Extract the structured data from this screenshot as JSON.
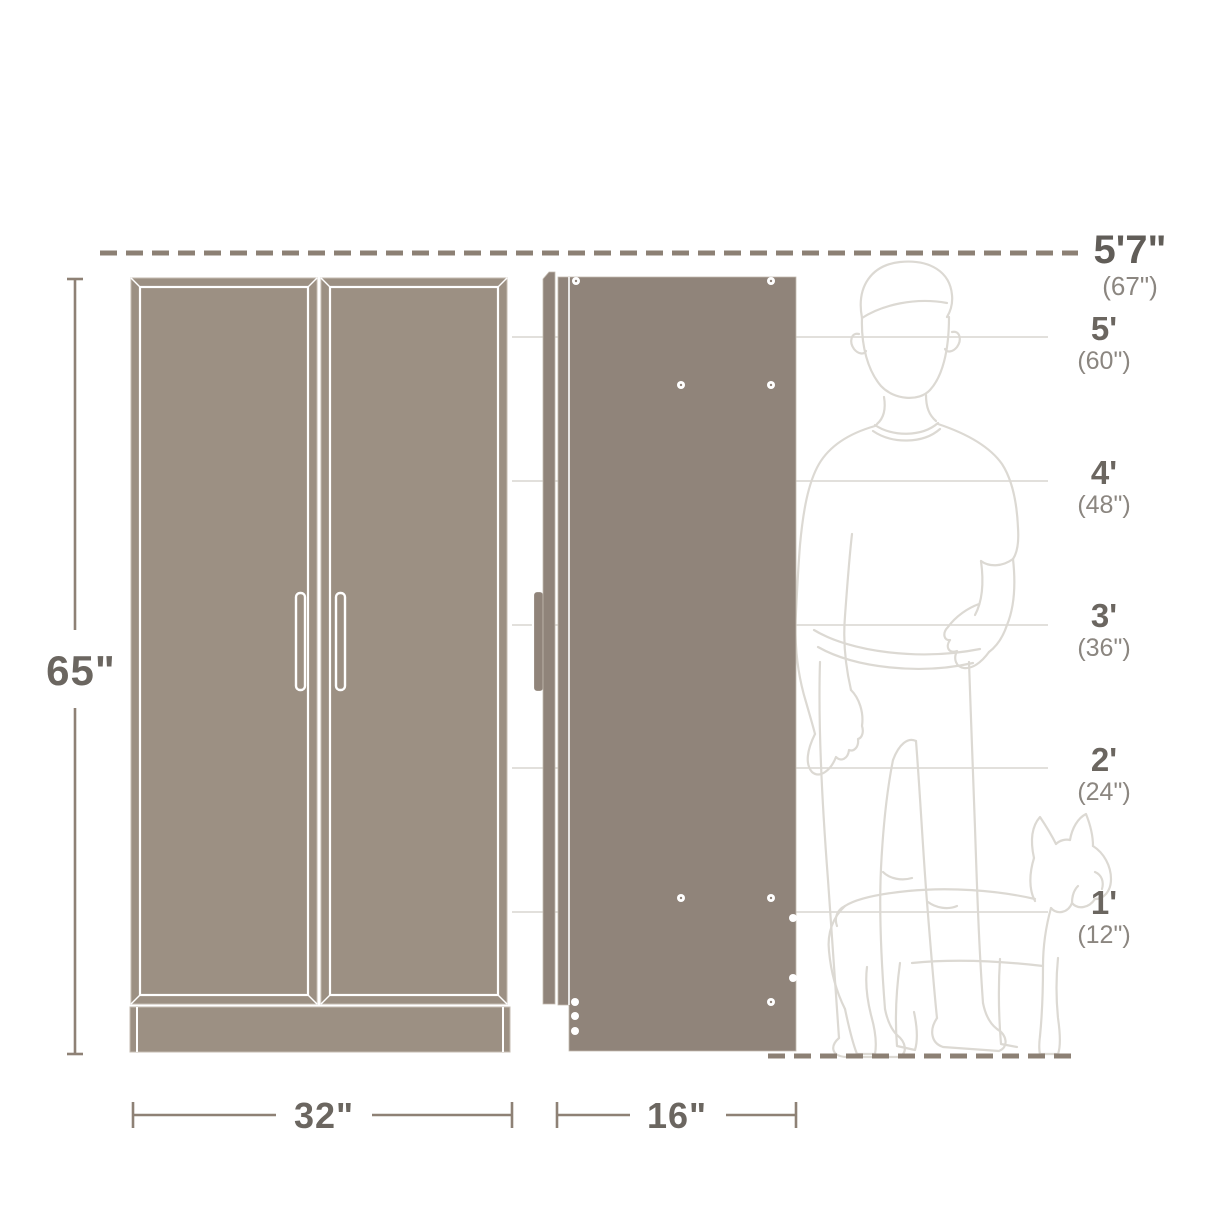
{
  "diagram": {
    "type": "furniture-dimension-diagram",
    "description": "Two-door storage cabinet shown in front view and side view beside outline silhouettes of a person and a dog for height comparison"
  },
  "dimensions": {
    "height": "65\"",
    "width": "32\"",
    "depth": "16\""
  },
  "height_scale": {
    "items": [
      {
        "feet": "5'7\"",
        "inches": "(67\")"
      },
      {
        "feet": "5'",
        "inches": "(60\")"
      },
      {
        "feet": "4'",
        "inches": "(48\")"
      },
      {
        "feet": "3'",
        "inches": "(36\")"
      },
      {
        "feet": "2'",
        "inches": "(24\")"
      },
      {
        "feet": "1'",
        "inches": "(12\")"
      }
    ]
  },
  "colors": {
    "cabinet_fill": "#9c9083",
    "cabinet_side_fill": "#90847a",
    "dashed_line": "#8c8074",
    "dimension_line": "#8e8175",
    "primary_text": "#6b6660",
    "secondary_text": "#8b8680",
    "grid_line": "#d9d6d1",
    "silhouette_line": "#dcd9d3",
    "background": "#ffffff"
  }
}
